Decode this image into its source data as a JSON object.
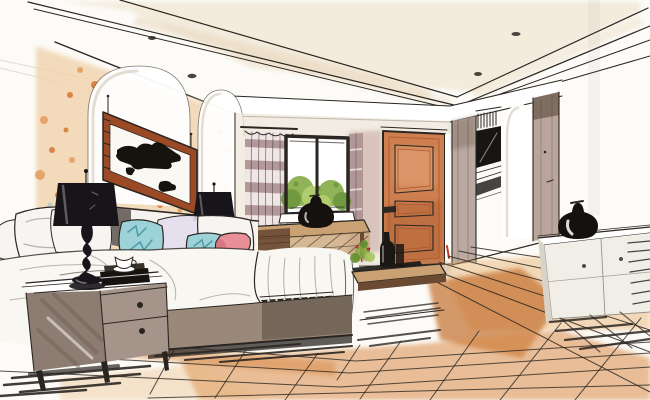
{
  "image": {
    "kind": "hand-drawn interior design sketch",
    "room": "bedroom",
    "style": "watercolor and marker perspective rendering",
    "width_px": 650,
    "height_px": 400
  },
  "palette": {
    "white": "#ffffff",
    "paper": "#fcfbf7",
    "ink": "#2b2621",
    "fold": "#a9a19a",
    "ceiling_wash": "#e9d8bd",
    "wall_peach": "#f0d3ad",
    "speckle_orange": "#e59a5c",
    "speckle_deep": "#d9762f",
    "speckle_gray": "#b9c7cc",
    "arch_shadow": "#d8cec2",
    "frame_wood": "#9c4a26",
    "mat_white": "#faf8f3",
    "art_ink": "#16130f",
    "lamp_black": "#17151a",
    "headboard": "#f6f3ee",
    "headboard_shadow": "#5b524d",
    "pillow_white": "#f7f5f1",
    "pillow_lavender": "#e4dded",
    "pillow_teal": "#9dd2d8",
    "teal_stroke": "#4d9aa6",
    "pillow_coral": "#e88f97",
    "coral_deep": "#cf6f7c",
    "duvet": "#f9f7f2",
    "bed_base": "#9a8878",
    "bed_base_dark": "#4f453c",
    "nightstand_front": "#a5948a",
    "nightstand_side": "#8d7c72",
    "nightstand_streak": "#6e5d52",
    "knob": "#2a241f",
    "window_frame": "#1d1b18",
    "leaf_light": "#a9c75e",
    "leaf_mid": "#86ab45",
    "leaf_dark": "#62902c",
    "curtain_mauve": "#a8898d",
    "curtain_light": "#eee6e5",
    "console_wood": "#c9a172",
    "console_dark": "#6b4a33",
    "door_orange": "#cd7f50",
    "door_dark": "#a85a2e",
    "door_light": "#e2a276",
    "door_accent": "#c33b1e",
    "wall_mauve": "#c7aba3",
    "backwall": "#efe7db",
    "wardrobe_taupe": "#b5a097",
    "wardrobe_dark": "#756357",
    "tv_black": "#171614",
    "dresser_face": "#f1eee7",
    "dresser_side": "#d8d2c8",
    "dresser_line": "#9a938a",
    "vase_black": "#14110e",
    "floor_deep": "#c4702f",
    "floor_mid": "#d98b4a",
    "floor_light": "#eab678",
    "plant_green": "#6f9a3a",
    "bottle_black": "#1b1814",
    "berry_red": "#b8372a",
    "shadow_gray": "#8e857c"
  },
  "scene": {
    "objects": [
      {
        "name": "tray-ceiling",
        "downlight_count": 4
      },
      {
        "name": "arched-wall-niche",
        "count": 2
      },
      {
        "name": "framed-abstract-artwork"
      },
      {
        "name": "black-table-lamp",
        "count": 2
      },
      {
        "name": "throw-pillows",
        "white": 5,
        "teal": 2,
        "lavender": 1
      },
      {
        "name": "coral-bolster-pillow"
      },
      {
        "name": "bed-with-white-duvet"
      },
      {
        "name": "fringed-throw-blanket"
      },
      {
        "name": "two-drawer-nightstand"
      },
      {
        "name": "teacup-and-books"
      },
      {
        "name": "striped-curtain"
      },
      {
        "name": "window-with-garden-view"
      },
      {
        "name": "console-desk"
      },
      {
        "name": "black-vase",
        "count": 2
      },
      {
        "name": "paneled-wood-door"
      },
      {
        "name": "wardrobe-with-tv-niche"
      },
      {
        "name": "low-dresser"
      },
      {
        "name": "wood-bench-with-plant-and-bottles"
      },
      {
        "name": "plank-wood-floor"
      }
    ]
  }
}
